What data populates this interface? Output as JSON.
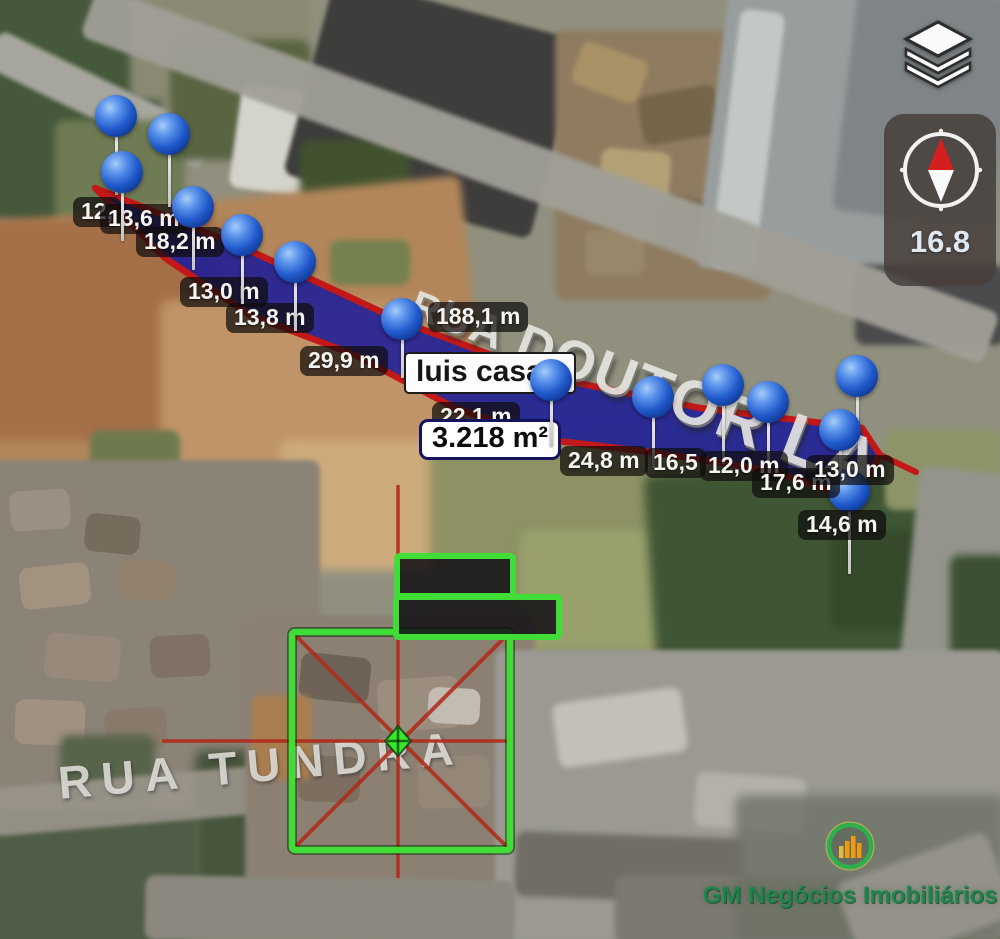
{
  "map": {
    "streets": {
      "main": "RUA DOUTOR LA",
      "secondary": "RUA TUNDRA"
    }
  },
  "controls": {
    "layers_icon": "layers-icon",
    "compass_bearing": "16.8"
  },
  "watermark": {
    "text": "GM Negócios Imobiliários"
  },
  "colors": {
    "polygon_fill": "#1d1d97",
    "polygon_stroke": "#c41818",
    "overlay_green": "#3fdd35",
    "crosshair_red": "#b02a1a",
    "pin_blue": "#2059ca"
  },
  "measurement": {
    "labels": [
      {
        "text": "12,",
        "x": 73,
        "y": 197,
        "kind": "pill"
      },
      {
        "text": "13,6 m",
        "x": 100,
        "y": 204,
        "kind": "pill"
      },
      {
        "text": "18,2 m",
        "x": 136,
        "y": 227,
        "kind": "pill"
      },
      {
        "text": "13,0 m",
        "x": 180,
        "y": 277,
        "kind": "pill"
      },
      {
        "text": "13,8 m",
        "x": 226,
        "y": 303,
        "kind": "pill"
      },
      {
        "text": "29,9 m",
        "x": 300,
        "y": 346,
        "kind": "pill"
      },
      {
        "text": "188,1 m",
        "x": 428,
        "y": 302,
        "kind": "pill"
      },
      {
        "text": "22,1 m",
        "x": 432,
        "y": 402,
        "kind": "pill"
      },
      {
        "text": "luis casa",
        "x": 404,
        "y": 352,
        "kind": "white"
      },
      {
        "text": "3.218 m²",
        "x": 419,
        "y": 419,
        "kind": "area"
      },
      {
        "text": "24,8 m",
        "x": 560,
        "y": 446,
        "kind": "pill"
      },
      {
        "text": "16,5",
        "x": 645,
        "y": 448,
        "kind": "pill"
      },
      {
        "text": "12,0 m",
        "x": 700,
        "y": 451,
        "kind": "pill"
      },
      {
        "text": "17,6 m",
        "x": 752,
        "y": 468,
        "kind": "pill"
      },
      {
        "text": "13,0 m",
        "x": 806,
        "y": 455,
        "kind": "pill"
      },
      {
        "text": "14,6 m",
        "x": 798,
        "y": 510,
        "kind": "pill"
      }
    ],
    "pins": [
      {
        "x": 116,
        "y": 116,
        "len": 58
      },
      {
        "x": 169,
        "y": 134,
        "len": 52
      },
      {
        "x": 122,
        "y": 172,
        "len": 48
      },
      {
        "x": 193,
        "y": 207,
        "len": 42
      },
      {
        "x": 242,
        "y": 235,
        "len": 48
      },
      {
        "x": 295,
        "y": 262,
        "len": 48
      },
      {
        "x": 402,
        "y": 319,
        "len": 38
      },
      {
        "x": 551,
        "y": 380,
        "len": 45
      },
      {
        "x": 653,
        "y": 397,
        "len": 50
      },
      {
        "x": 723,
        "y": 385,
        "len": 58
      },
      {
        "x": 768,
        "y": 402,
        "len": 60
      },
      {
        "x": 857,
        "y": 376,
        "len": 42
      },
      {
        "x": 840,
        "y": 430,
        "len": 48
      },
      {
        "x": 849,
        "y": 491,
        "len": 62
      }
    ],
    "geometry": {
      "polygon": "95,188 240,246 403,322 553,378 700,408 862,428 880,455 853,498 768,470 650,452 550,440 455,408 355,355 250,315 165,258",
      "street_extension": "880,455 916,472"
    }
  },
  "site_plan": {
    "square": {
      "x": 292,
      "y": 632,
      "w": 218,
      "h": 218
    },
    "rects": [
      {
        "x": 397,
        "y": 556,
        "w": 116,
        "h": 40
      },
      {
        "x": 396,
        "y": 597,
        "w": 163,
        "h": 40
      }
    ],
    "crosshair": {
      "vx": 398,
      "vy1": 485,
      "vy2": 878,
      "hy": 741,
      "hx1": 162,
      "hx2": 510
    },
    "marker": {
      "x": 398,
      "y": 741
    }
  }
}
